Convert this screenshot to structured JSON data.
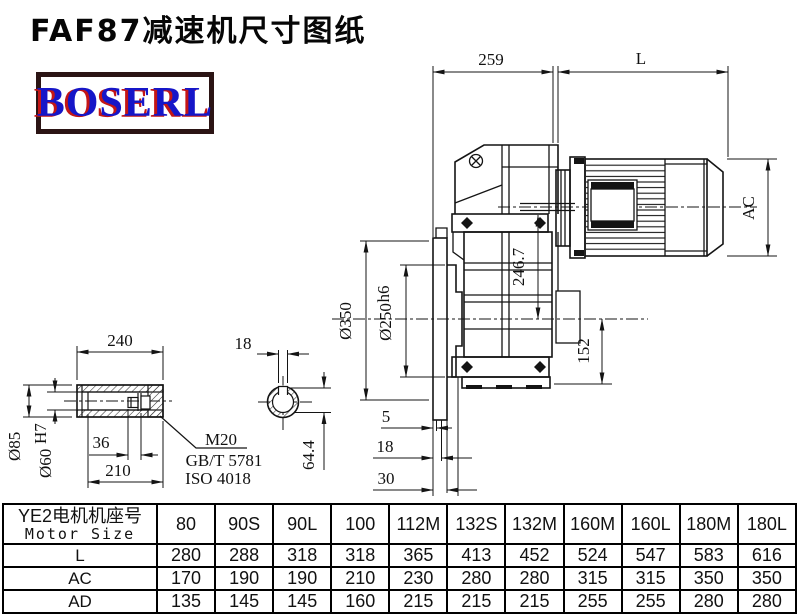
{
  "page": {
    "title": "FAF87减速机尺寸图纸"
  },
  "logo": {
    "text": "BOSERL",
    "text_color": "#1616c8",
    "shadow_color": "#c41616",
    "border_color": "#2b1414"
  },
  "drawing": {
    "main_view": {
      "dims": {
        "width_259": "259",
        "motor_length": "L",
        "motor_diameter": "AC",
        "flange_diameter": "Ø350",
        "spigot_diameter": "Ø250",
        "spigot_tolerance": "h6",
        "axis_height": "246.7",
        "bottom_height": "152",
        "step_5": "5",
        "step_18": "18",
        "step_30": "30"
      }
    },
    "shaft_view": {
      "dims": {
        "length_240": "240",
        "outer_diameter": "Ø85",
        "bore_diameter": "Ø60",
        "bore_tolerance": "H7",
        "bolt_36": "36",
        "length_210": "210"
      },
      "bolt_note": {
        "line1": "M20",
        "line2": "GB/T 5781",
        "line3": "ISO 4018"
      }
    },
    "section_view": {
      "dims": {
        "keyway_width": "18",
        "keyway_depth": "64.4"
      }
    }
  },
  "table": {
    "header": {
      "cn": "YE2电机机座号",
      "en": "Motor Size"
    },
    "columns": [
      "80",
      "90S",
      "90L",
      "100",
      "112M",
      "132S",
      "132M",
      "160M",
      "160L",
      "180M",
      "180L"
    ],
    "rows": [
      {
        "label": "L",
        "values": [
          "280",
          "288",
          "318",
          "318",
          "365",
          "413",
          "452",
          "524",
          "547",
          "583",
          "616"
        ]
      },
      {
        "label": "AC",
        "values": [
          "170",
          "190",
          "190",
          "210",
          "230",
          "280",
          "280",
          "315",
          "315",
          "350",
          "350"
        ]
      },
      {
        "label": "AD",
        "values": [
          "135",
          "145",
          "145",
          "160",
          "215",
          "215",
          "215",
          "255",
          "255",
          "280",
          "280"
        ]
      }
    ]
  }
}
